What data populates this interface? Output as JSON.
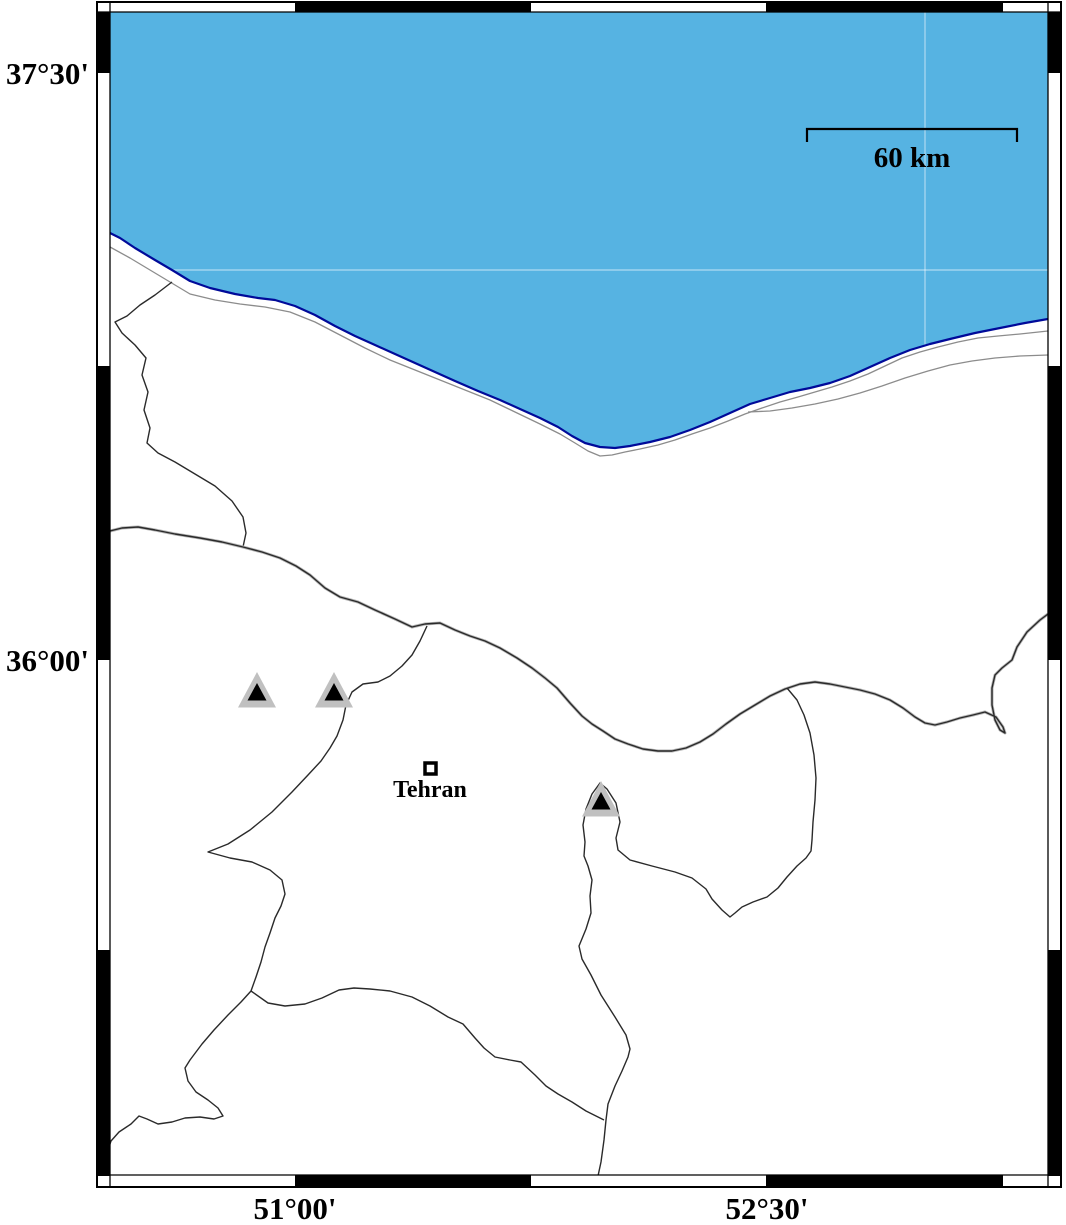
{
  "labels": {
    "latitude": [
      "37°30'",
      "36°00'"
    ],
    "longitude": [
      "51°00'",
      "52°30'"
    ],
    "scale_bar": "60 km",
    "city": "Tehran"
  },
  "colors": {
    "sea": "#56b3e2",
    "coastline": "#000a99",
    "boundary": "#2a2a2a",
    "secondary_line": "#8c8c8c",
    "marker_fill": "#c0c0c0",
    "marker_core": "#000000",
    "frame_black": "#000000"
  },
  "markers": {
    "volcano_triangles": [
      {
        "x": 257,
        "y": 691
      },
      {
        "x": 334,
        "y": 691
      },
      {
        "x": 601,
        "y": 800
      }
    ],
    "city_square": {
      "x": 430,
      "y": 769
    }
  }
}
